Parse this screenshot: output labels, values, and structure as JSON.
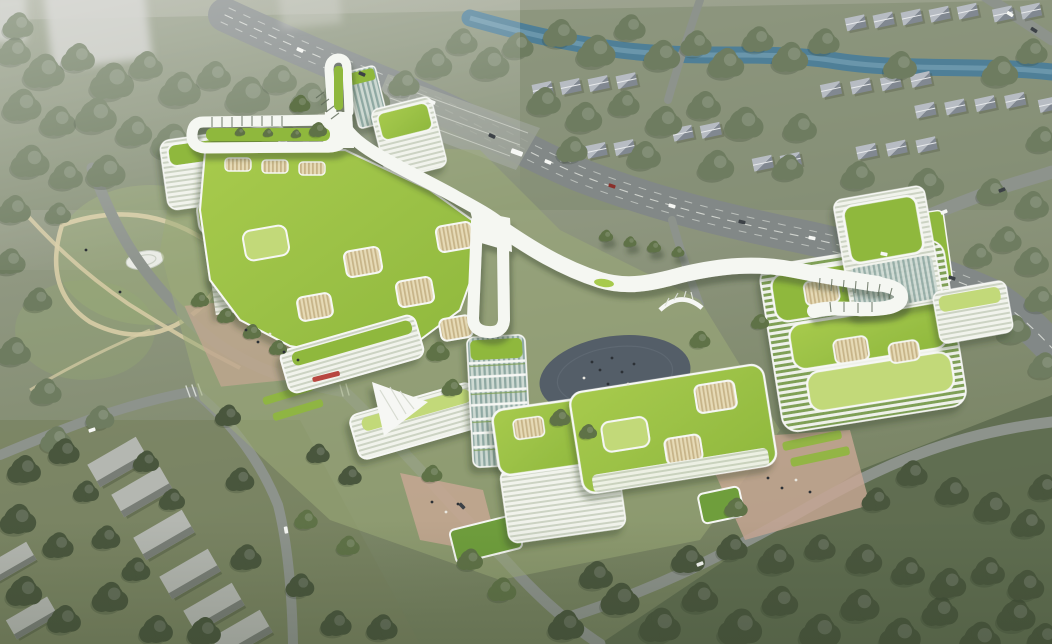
{
  "scene": {
    "type": "architectural-aerial-rendering",
    "subject": "Aerial rendering of a green hospital campus with a looping white rooftop ribbon road, green roofs, surrounding park, river, highway and residential blocks",
    "elements": [
      "ribbon-rooftop-loop",
      "hospital-campus-buildings",
      "green-roof-terraces",
      "courtyard-lightwells",
      "central-dark-plaza",
      "helipad",
      "west-park",
      "river",
      "highway",
      "townhouse-rows",
      "residential-slab-blocks",
      "tree-canopy",
      "entry-plazas",
      "sunken-gardens",
      "parking-area",
      "cars",
      "pedestrians",
      "hazy-highrise-towers"
    ]
  },
  "palette": {
    "bg_top": "#a3a896",
    "bg_mid": "#8e967f",
    "bg_low": "#75815f",
    "haze": "#c9cac4",
    "tree_top": "#6e7c60",
    "tree_mid": "#5f7247",
    "tree_dark": "#49563d",
    "river": "#4f7f97",
    "river_hi": "#85aebf",
    "road": "#828887",
    "road_minor": "#8d938c",
    "road_line": "#e9ece6",
    "ribbon": "#f5f7f2",
    "ribbon_shadow": "#3a4834",
    "roof_bright": "#a7ca4d",
    "roof_mid": "#8fb83e",
    "roof_pale": "#c2d979",
    "lawn": "#9cab79",
    "facade_a": "#f1f3ec",
    "facade_b": "#ccd3c3",
    "glass_a": "#8fa9a3",
    "glass_b": "#cdd9d2",
    "green_fac_a": "#eef1e9",
    "green_fac_b": "#7fa055",
    "slat_a": "#e6dab6",
    "slat_b": "#c7b488",
    "plaza_pink": "#c9a795",
    "plaza_dark": "#545e68",
    "concrete": "#b4b7b1",
    "concrete_side": "#787d76",
    "house_roof": "#b7bcc3",
    "house_side": "#818891",
    "path_tan": "#d8cda6",
    "white": "#f6f7f4",
    "car_dark": "#3c4146",
    "accent_red": "#b8473f",
    "pergola": "#5f6a58",
    "person_dark": "#2c3136"
  }
}
